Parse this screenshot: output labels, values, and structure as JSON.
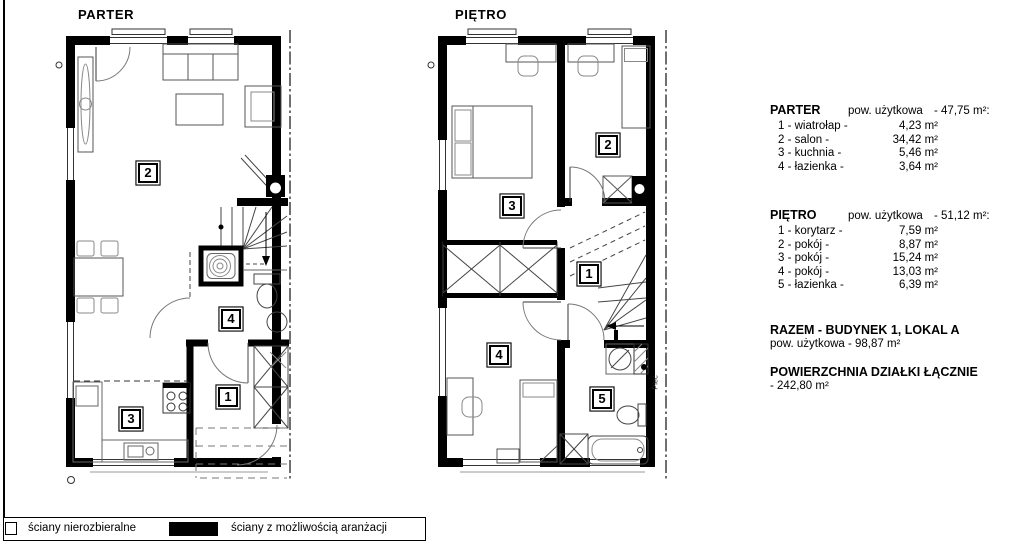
{
  "plans": {
    "parter": {
      "title": "PARTER",
      "labels": [
        "1",
        "2",
        "3",
        "4"
      ]
    },
    "pietro": {
      "title": "PIĘTRO",
      "labels": [
        "1",
        "2",
        "3",
        "4",
        "5"
      ],
      "annotation_piec": "Piec"
    }
  },
  "summary": {
    "parter": {
      "title": "PARTER",
      "area_label": "pow. użytkowa",
      "area_total": "- 47,75 m²:",
      "rooms": [
        {
          "name": "1 - wiatrołap -",
          "area": "4,23 m²"
        },
        {
          "name": "2 - salon -",
          "area": "34,42 m²"
        },
        {
          "name": "3 - kuchnia -",
          "area": "5,46 m²"
        },
        {
          "name": "4 - łazienka -",
          "area": "3,64 m²"
        }
      ]
    },
    "pietro": {
      "title": "PIĘTRO",
      "area_label": "pow. użytkowa",
      "area_total": "- 51,12 m²:",
      "rooms": [
        {
          "name": "1 - korytarz -",
          "area": "7,59 m²"
        },
        {
          "name": "2 - pokój -",
          "area": "8,87 m²"
        },
        {
          "name": "3 - pokój -",
          "area": "15,24 m²"
        },
        {
          "name": "4 - pokój -",
          "area": "13,03 m²"
        },
        {
          "name": "5 - łazienka -",
          "area": "6,39 m²"
        }
      ]
    },
    "building_total": {
      "line1": "RAZEM - BUDYNEK 1, LOKAL A",
      "line2": "pow. użytkowa - 98,87 m²"
    },
    "plot_total": {
      "line1": "POWIERZCHNIA DZIAŁKI ŁĄCZNIE",
      "line2": "- 242,80 m²"
    }
  },
  "legend": {
    "items": [
      {
        "label": "ściany nierozbieralne",
        "swatch": "outline"
      },
      {
        "label": "ściany z możliwością aranżacji",
        "swatch": "filled"
      }
    ]
  },
  "colors": {
    "wall": "#000000",
    "furniture": "#555555",
    "background": "#ffffff"
  }
}
